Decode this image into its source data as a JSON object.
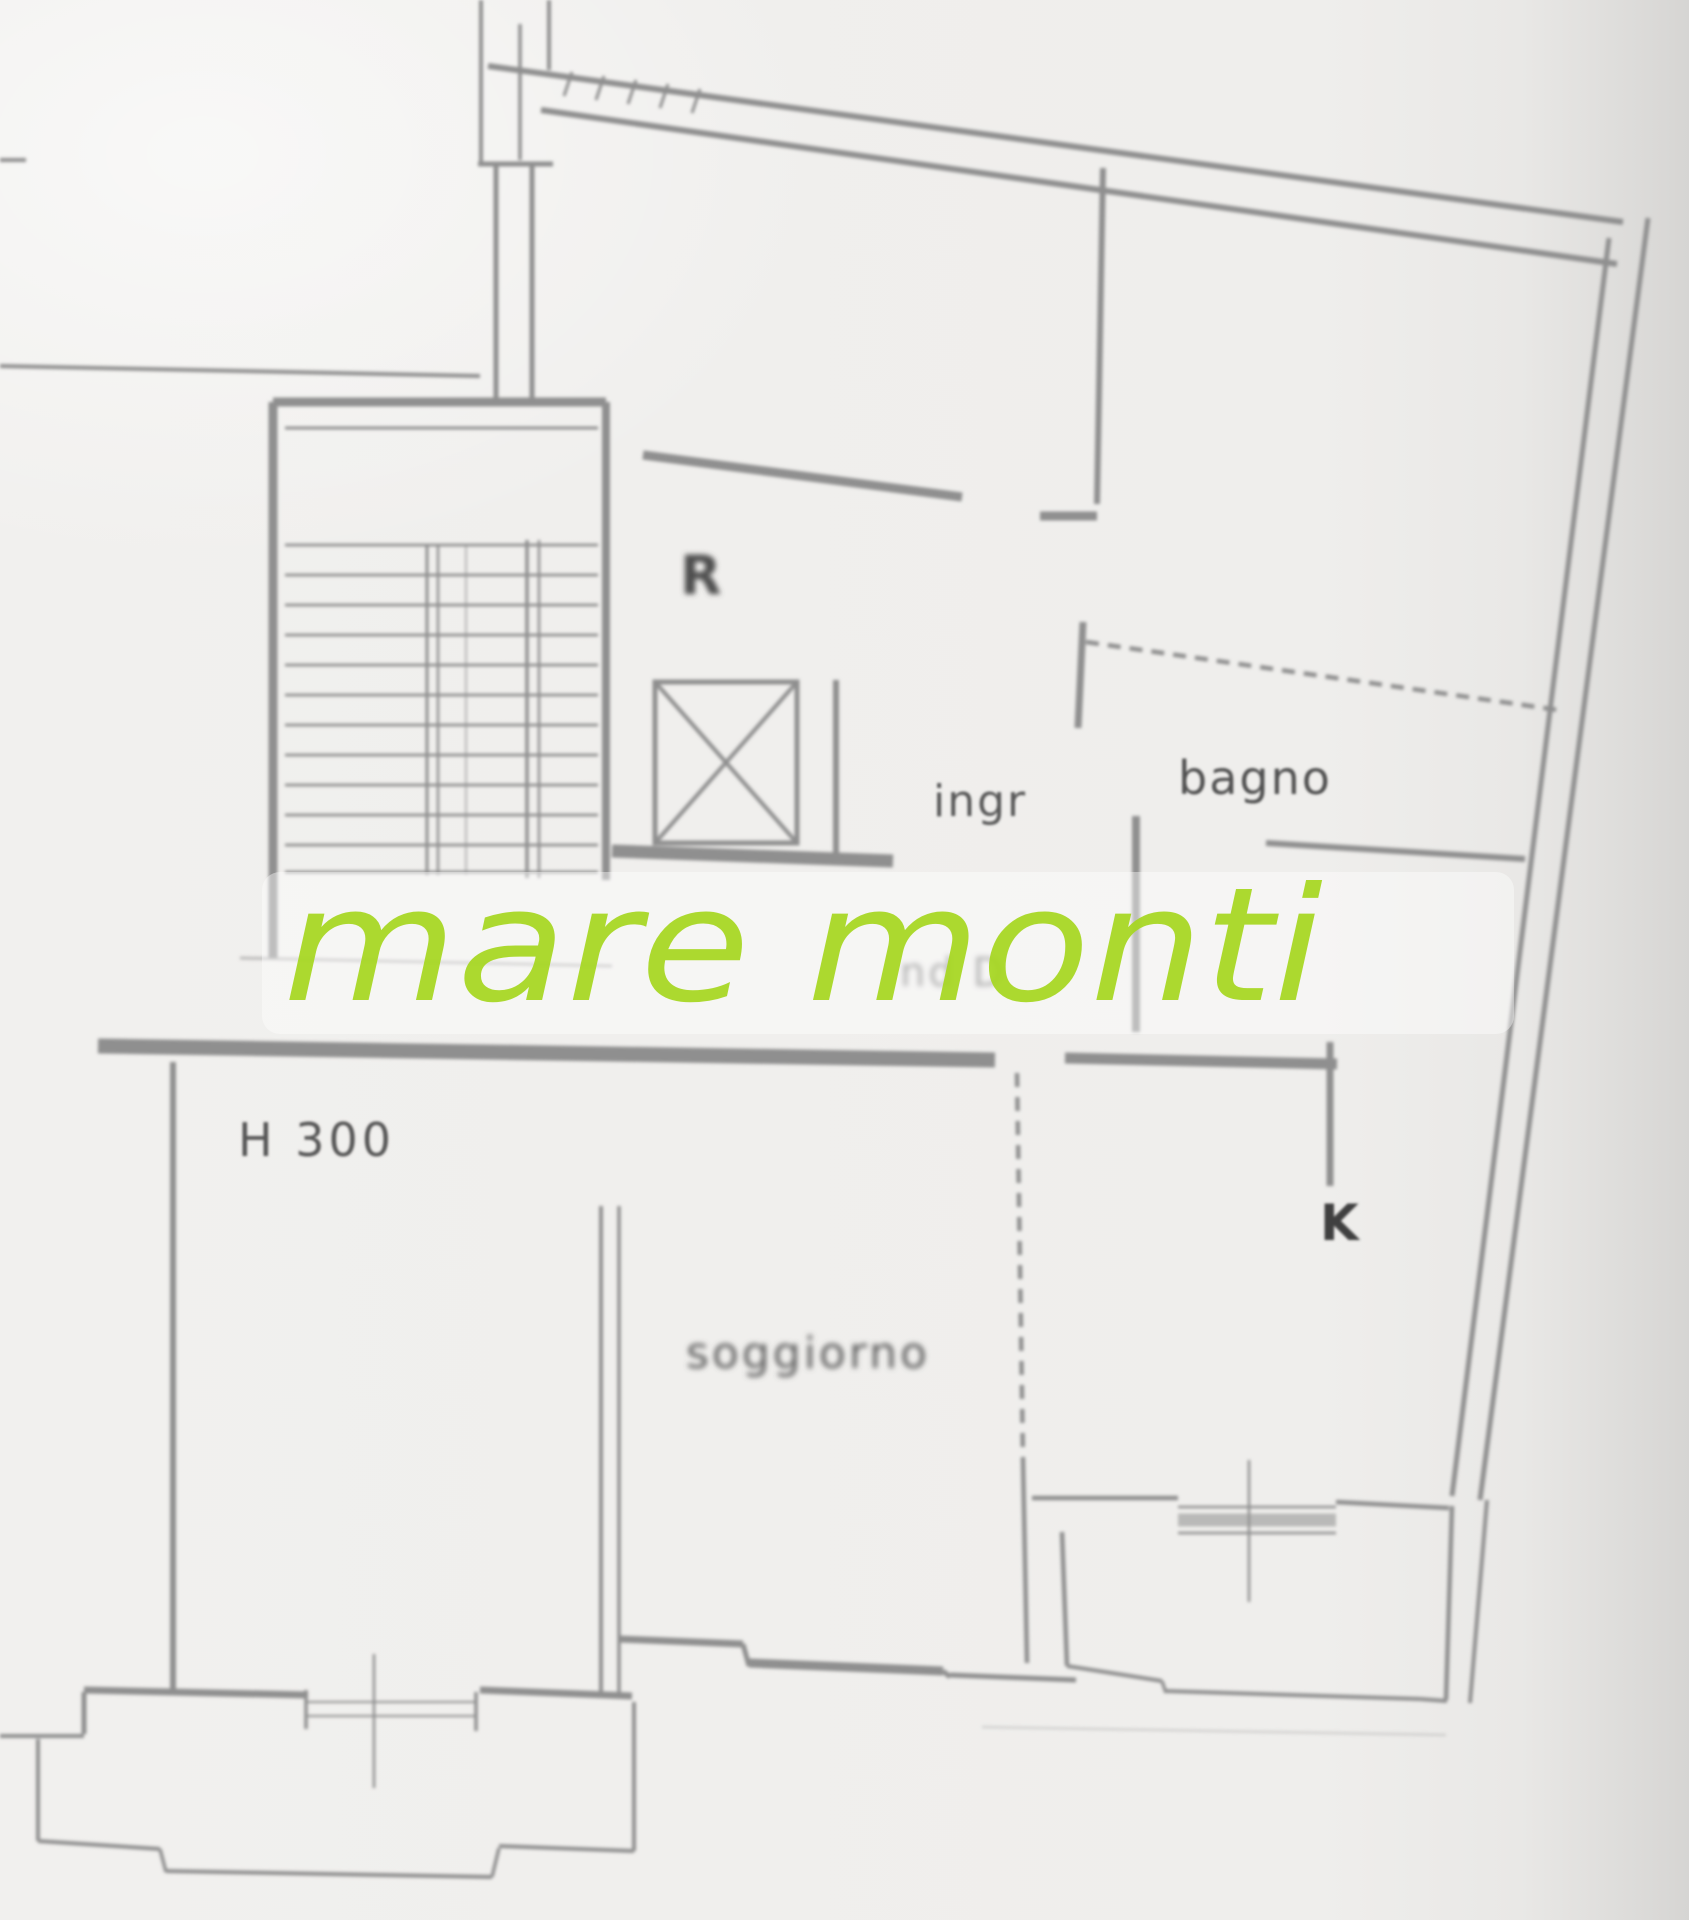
{
  "watermark": {
    "text": "mare monti",
    "color": "#a6d71f"
  },
  "labels": {
    "stairwell": "R",
    "entrance": "ingr",
    "bathroom": "bagno",
    "height_note": "H 300",
    "living_room": "soggiorno",
    "kitchen": "K",
    "obscured_text": "nd D"
  },
  "colors": {
    "paper": "#efeeec",
    "wall": "#8f8f8f",
    "label": "#5a5a5a",
    "watermark_green": "#a6d71f"
  }
}
